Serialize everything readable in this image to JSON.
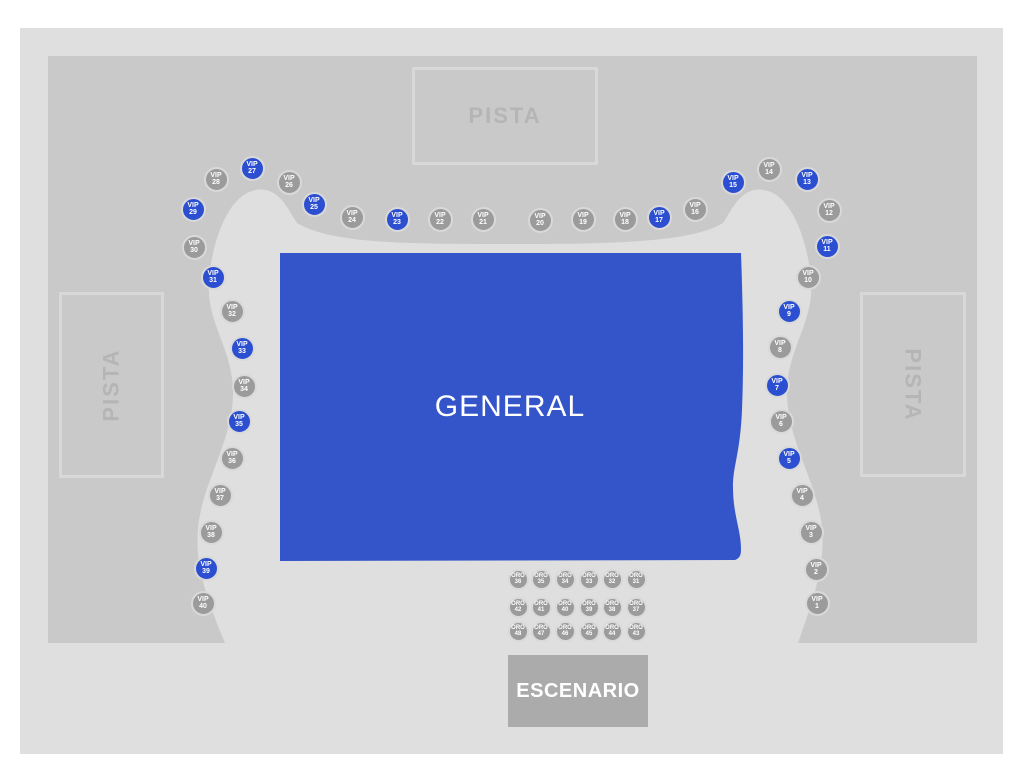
{
  "colors": {
    "page_bg": "#ffffff",
    "floor_bg": "#dfdfdf",
    "stands": "#c9c9c9",
    "walkway": "#dfdfdf",
    "general_fill": "#3355c9",
    "seat_available": "#2b4fd0",
    "seat_unavailable": "#9b9b9b",
    "seat_ring": "#d9d9d9",
    "stage_fill": "#ababab",
    "pista_border": "#d8d8d8",
    "pista_text": "#b5b5b5"
  },
  "labels": {
    "general": "GENERAL",
    "stage": "ESCENARIO",
    "pista_top": "PISTA",
    "pista_left": "PISTA",
    "pista_right": "PISTA"
  },
  "seats": {
    "vip": [
      {
        "label": "VIP",
        "number": "1",
        "x": 817,
        "y": 603,
        "available": false
      },
      {
        "label": "VIP",
        "number": "2",
        "x": 816,
        "y": 569,
        "available": false
      },
      {
        "label": "VIP",
        "number": "3",
        "x": 811,
        "y": 532,
        "available": false
      },
      {
        "label": "VIP",
        "number": "4",
        "x": 802,
        "y": 495,
        "available": false
      },
      {
        "label": "VIP",
        "number": "5",
        "x": 789,
        "y": 458,
        "available": true
      },
      {
        "label": "VIP",
        "number": "6",
        "x": 781,
        "y": 421,
        "available": false
      },
      {
        "label": "VIP",
        "number": "7",
        "x": 777,
        "y": 385,
        "available": true
      },
      {
        "label": "VIP",
        "number": "8",
        "x": 780,
        "y": 347,
        "available": false
      },
      {
        "label": "VIP",
        "number": "9",
        "x": 789,
        "y": 311,
        "available": true
      },
      {
        "label": "VIP",
        "number": "10",
        "x": 808,
        "y": 277,
        "available": false
      },
      {
        "label": "VIP",
        "number": "11",
        "x": 827,
        "y": 246,
        "available": true
      },
      {
        "label": "VIP",
        "number": "12",
        "x": 829,
        "y": 210,
        "available": false
      },
      {
        "label": "VIP",
        "number": "13",
        "x": 807,
        "y": 179,
        "available": true
      },
      {
        "label": "VIP",
        "number": "14",
        "x": 769,
        "y": 169,
        "available": false
      },
      {
        "label": "VIP",
        "number": "15",
        "x": 733,
        "y": 182,
        "available": true
      },
      {
        "label": "VIP",
        "number": "16",
        "x": 695,
        "y": 209,
        "available": false
      },
      {
        "label": "VIP",
        "number": "17",
        "x": 659,
        "y": 217,
        "available": true
      },
      {
        "label": "VIP",
        "number": "18",
        "x": 625,
        "y": 219,
        "available": false
      },
      {
        "label": "VIP",
        "number": "19",
        "x": 583,
        "y": 219,
        "available": false
      },
      {
        "label": "VIP",
        "number": "20",
        "x": 540,
        "y": 220,
        "available": false
      },
      {
        "label": "VIP",
        "number": "21",
        "x": 483,
        "y": 219,
        "available": false
      },
      {
        "label": "VIP",
        "number": "22",
        "x": 440,
        "y": 219,
        "available": false
      },
      {
        "label": "VIP",
        "number": "23",
        "x": 397,
        "y": 219,
        "available": true
      },
      {
        "label": "VIP",
        "number": "24",
        "x": 352,
        "y": 217,
        "available": false
      },
      {
        "label": "VIP",
        "number": "25",
        "x": 314,
        "y": 204,
        "available": true
      },
      {
        "label": "VIP",
        "number": "26",
        "x": 289,
        "y": 182,
        "available": false
      },
      {
        "label": "VIP",
        "number": "27",
        "x": 252,
        "y": 168,
        "available": true
      },
      {
        "label": "VIP",
        "number": "28",
        "x": 216,
        "y": 179,
        "available": false
      },
      {
        "label": "VIP",
        "number": "29",
        "x": 193,
        "y": 209,
        "available": true
      },
      {
        "label": "VIP",
        "number": "30",
        "x": 194,
        "y": 247,
        "available": false
      },
      {
        "label": "VIP",
        "number": "31",
        "x": 213,
        "y": 277,
        "available": true
      },
      {
        "label": "VIP",
        "number": "32",
        "x": 232,
        "y": 311,
        "available": false
      },
      {
        "label": "VIP",
        "number": "33",
        "x": 242,
        "y": 348,
        "available": true
      },
      {
        "label": "VIP",
        "number": "34",
        "x": 244,
        "y": 386,
        "available": false
      },
      {
        "label": "VIP",
        "number": "35",
        "x": 239,
        "y": 421,
        "available": true
      },
      {
        "label": "VIP",
        "number": "36",
        "x": 232,
        "y": 458,
        "available": false
      },
      {
        "label": "VIP",
        "number": "37",
        "x": 220,
        "y": 495,
        "available": false
      },
      {
        "label": "VIP",
        "number": "38",
        "x": 211,
        "y": 532,
        "available": false
      },
      {
        "label": "VIP",
        "number": "39",
        "x": 206,
        "y": 568,
        "available": true
      },
      {
        "label": "VIP",
        "number": "40",
        "x": 203,
        "y": 603,
        "available": false
      }
    ],
    "oro": [
      {
        "label": "ORO",
        "number": "36",
        "x": 518,
        "y": 579,
        "available": false
      },
      {
        "label": "ORO",
        "number": "35",
        "x": 541,
        "y": 579,
        "available": false
      },
      {
        "label": "ORO",
        "number": "34",
        "x": 565,
        "y": 579,
        "available": false
      },
      {
        "label": "ORO",
        "number": "33",
        "x": 589,
        "y": 579,
        "available": false
      },
      {
        "label": "ORO",
        "number": "32",
        "x": 612,
        "y": 579,
        "available": false
      },
      {
        "label": "ORO",
        "number": "31",
        "x": 636,
        "y": 579,
        "available": false
      },
      {
        "label": "ORO",
        "number": "42",
        "x": 518,
        "y": 607,
        "available": false
      },
      {
        "label": "ORO",
        "number": "41",
        "x": 541,
        "y": 607,
        "available": false
      },
      {
        "label": "ORO",
        "number": "40",
        "x": 565,
        "y": 607,
        "available": false
      },
      {
        "label": "ORO",
        "number": "39",
        "x": 589,
        "y": 607,
        "available": false
      },
      {
        "label": "ORO",
        "number": "38",
        "x": 612,
        "y": 607,
        "available": false
      },
      {
        "label": "ORO",
        "number": "37",
        "x": 636,
        "y": 607,
        "available": false
      },
      {
        "label": "ORO",
        "number": "48",
        "x": 518,
        "y": 631,
        "available": false
      },
      {
        "label": "ORO",
        "number": "47",
        "x": 541,
        "y": 631,
        "available": false
      },
      {
        "label": "ORO",
        "number": "46",
        "x": 565,
        "y": 631,
        "available": false
      },
      {
        "label": "ORO",
        "number": "45",
        "x": 589,
        "y": 631,
        "available": false
      },
      {
        "label": "ORO",
        "number": "44",
        "x": 612,
        "y": 631,
        "available": false
      },
      {
        "label": "ORO",
        "number": "43",
        "x": 636,
        "y": 631,
        "available": false
      }
    ]
  }
}
